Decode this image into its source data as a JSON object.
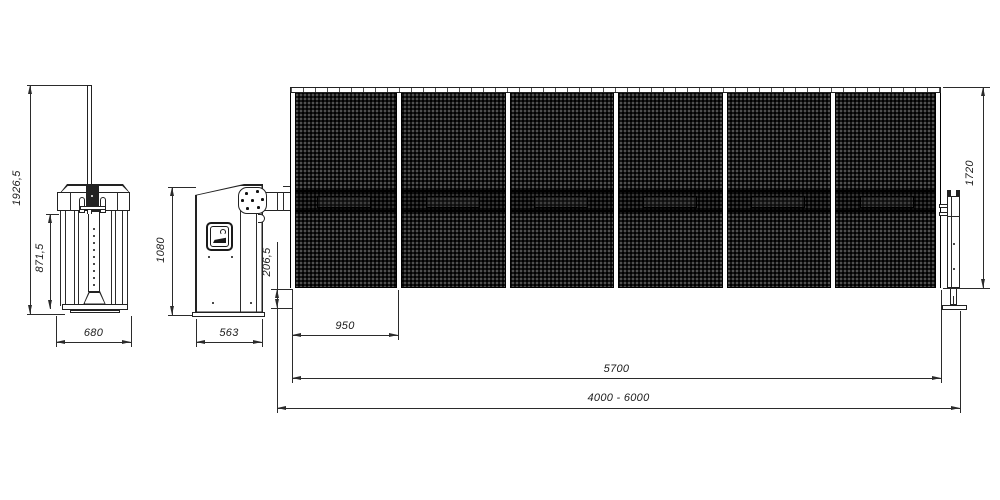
{
  "drawing": {
    "kind": "technical dimension drawing of an automatic barrier gate with mesh fence boom",
    "colors": {
      "line": "#2b2b2b",
      "mesh": "#181818",
      "background": "#ffffff"
    },
    "icons": {
      "logo_badge": "brand-emblem-badge"
    }
  },
  "dims": {
    "overall_height": "1926,5",
    "column_height": "871,5",
    "side_base_width": "680",
    "cabinet_height": "1080",
    "cabinet_width": "563",
    "ground_clearance": "206,5",
    "panel_width": "950",
    "fence_length": "5700",
    "opening_range": "4000 - 6000",
    "fence_height": "1720"
  }
}
